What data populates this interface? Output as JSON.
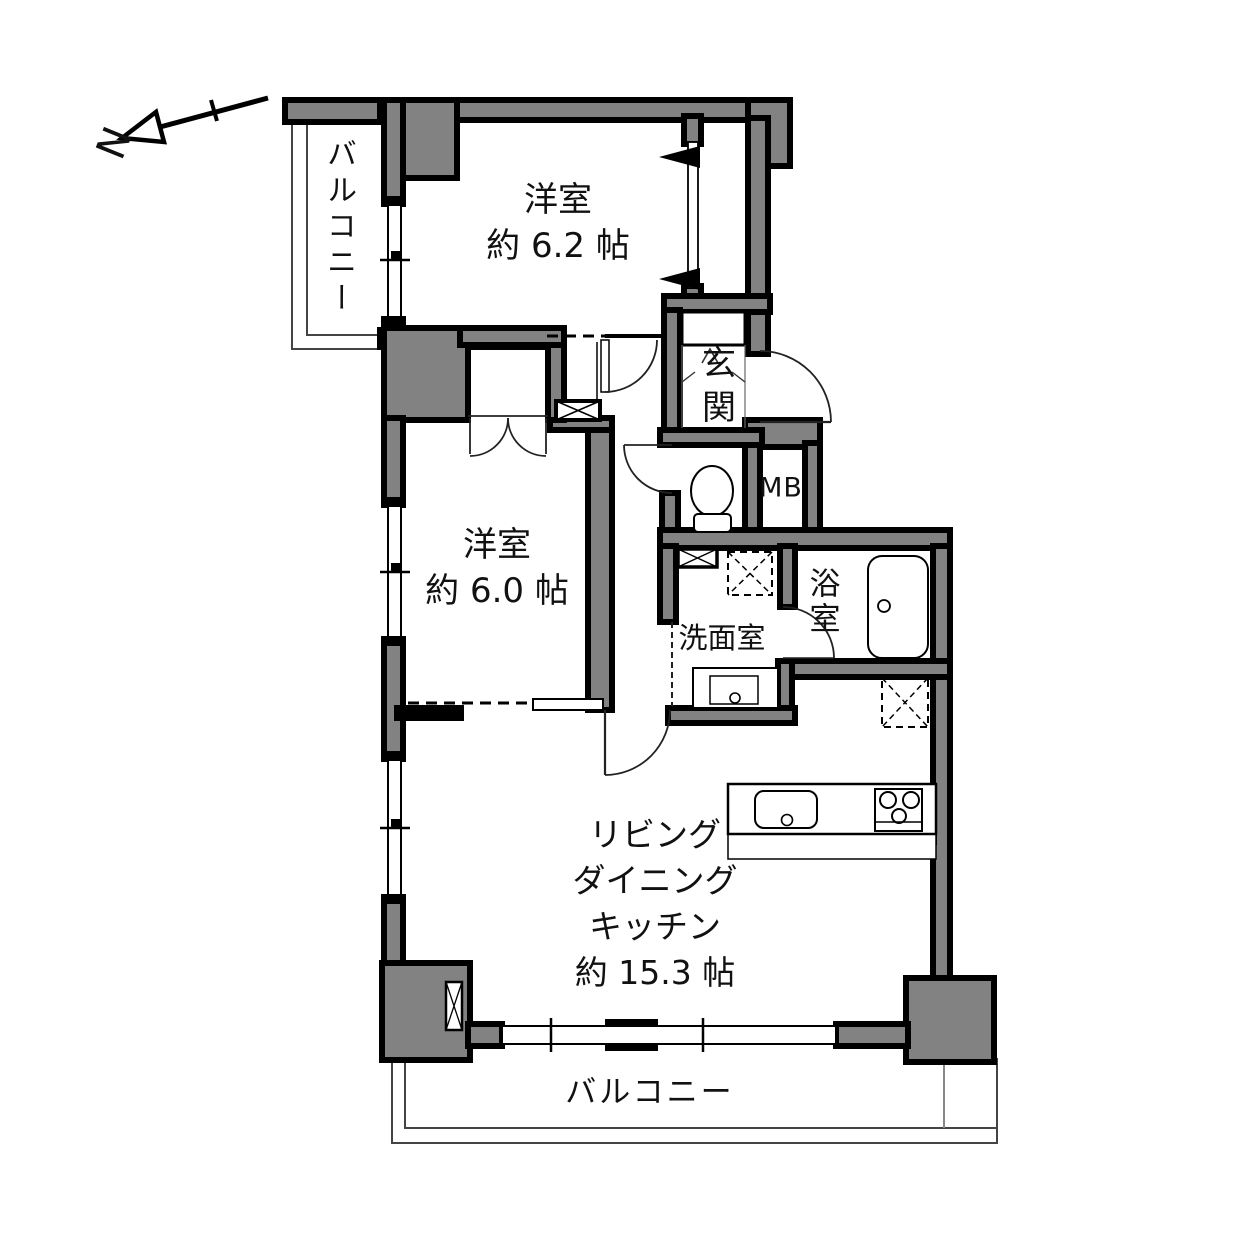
{
  "compass": {
    "label": "N"
  },
  "rooms": {
    "balcony_top": {
      "label": "バルコニー"
    },
    "bedroom1": {
      "name": "洋室",
      "size": "約 6.2 帖"
    },
    "bedroom2": {
      "name": "洋室",
      "size": "約 6.0 帖"
    },
    "entrance": {
      "label": "玄関"
    },
    "meter_box": {
      "label": "MB"
    },
    "bathroom": {
      "label": "浴室"
    },
    "washroom": {
      "label": "洗面室"
    },
    "ldk": {
      "line1": "リビング",
      "line2": "ダイニング",
      "line3": "キッチン",
      "size": "約 15.3 帖"
    },
    "balcony_bottom": {
      "label": "バルコニー"
    }
  },
  "colors": {
    "wall_fill": "#828282",
    "outline": "#000000",
    "background": "#ffffff",
    "thin_line": "#444444"
  }
}
